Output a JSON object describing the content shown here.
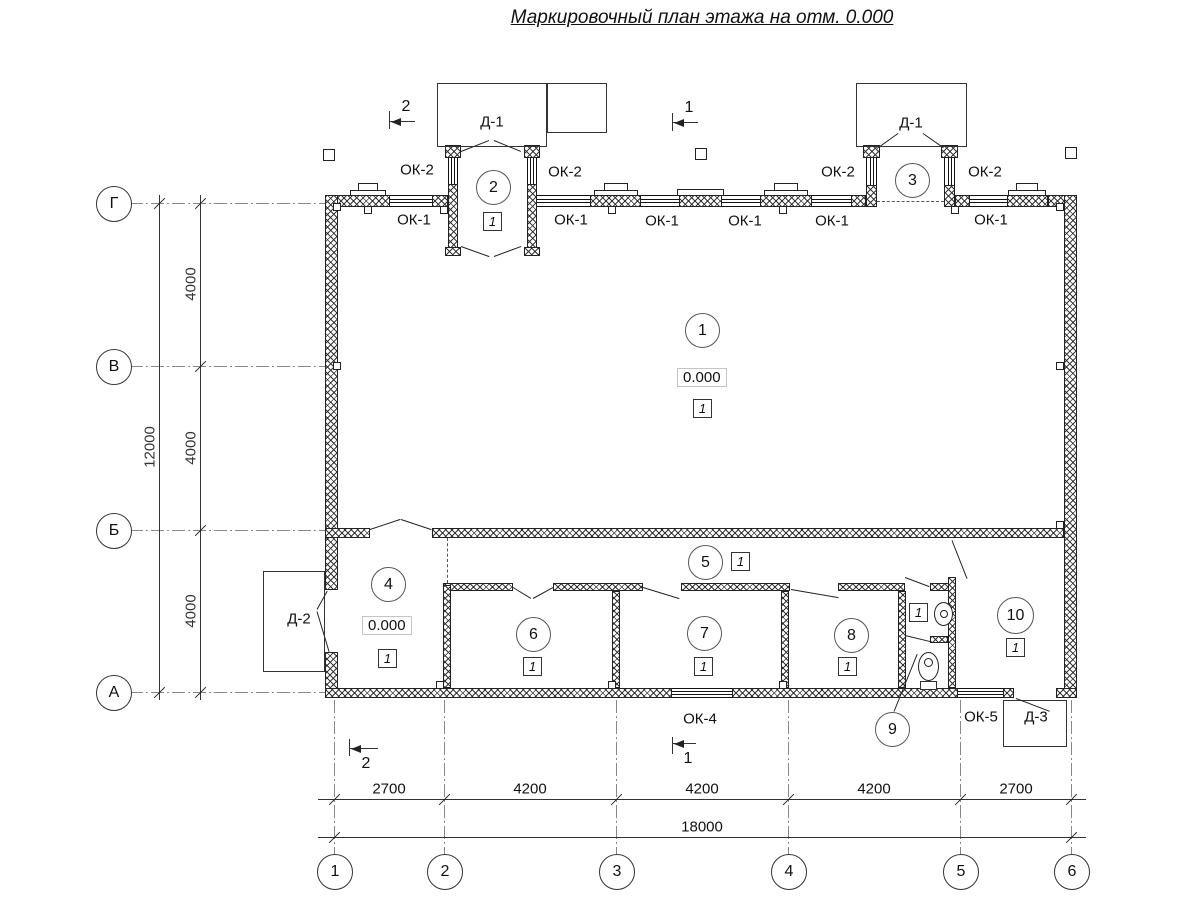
{
  "title": "Маркировочный план этажа на отм. 0.000",
  "labels": {
    "ok1": "ОК-1",
    "ok2": "ОК-2",
    "ok4": "ОК-4",
    "ok5": "ОК-5",
    "d1": "Д-1",
    "d2": "Д-2",
    "d3": "Д-3",
    "elevation": "0.000",
    "floor_type": "1"
  },
  "rooms": [
    "1",
    "2",
    "3",
    "4",
    "5",
    "6",
    "7",
    "8",
    "9",
    "10"
  ],
  "axes": {
    "rows": [
      "Г",
      "В",
      "Б",
      "А"
    ],
    "cols": [
      "1",
      "2",
      "3",
      "4",
      "5",
      "6"
    ]
  },
  "dims": {
    "left": [
      "4000",
      "4000",
      "4000"
    ],
    "left_total": "12000",
    "bottom": [
      "2700",
      "4200",
      "4200",
      "4200",
      "2700"
    ],
    "bottom_total": "18000"
  },
  "sections": {
    "s1": "1",
    "s2": "2"
  }
}
